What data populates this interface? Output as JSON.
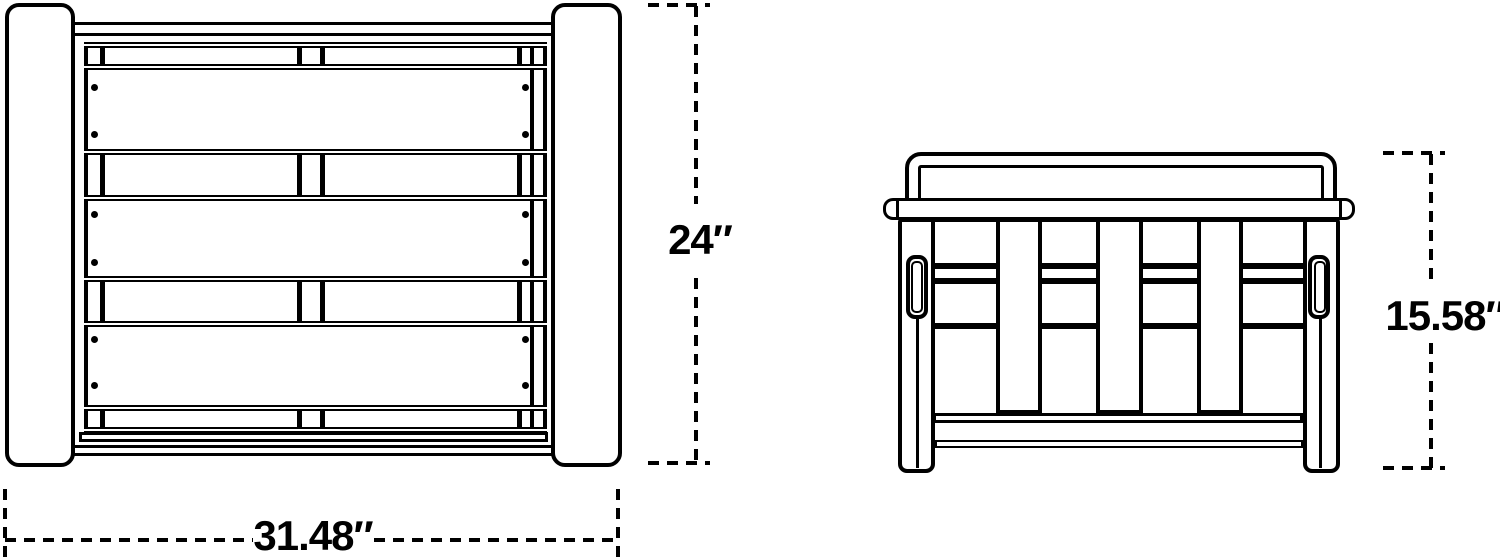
{
  "figure": {
    "type": "furniture-dimension-diagram",
    "background": "#ffffff",
    "line_color": "#000000",
    "views": [
      {
        "id": "front-view",
        "description": "front view of slatted frame with two side posts"
      },
      {
        "id": "side-view",
        "description": "side view with back bar, seat bar, vertical slats, side handle and legs"
      }
    ]
  },
  "labels": {
    "front_width": "31.48″",
    "front_height": "24″",
    "side_height": "15.58″"
  }
}
